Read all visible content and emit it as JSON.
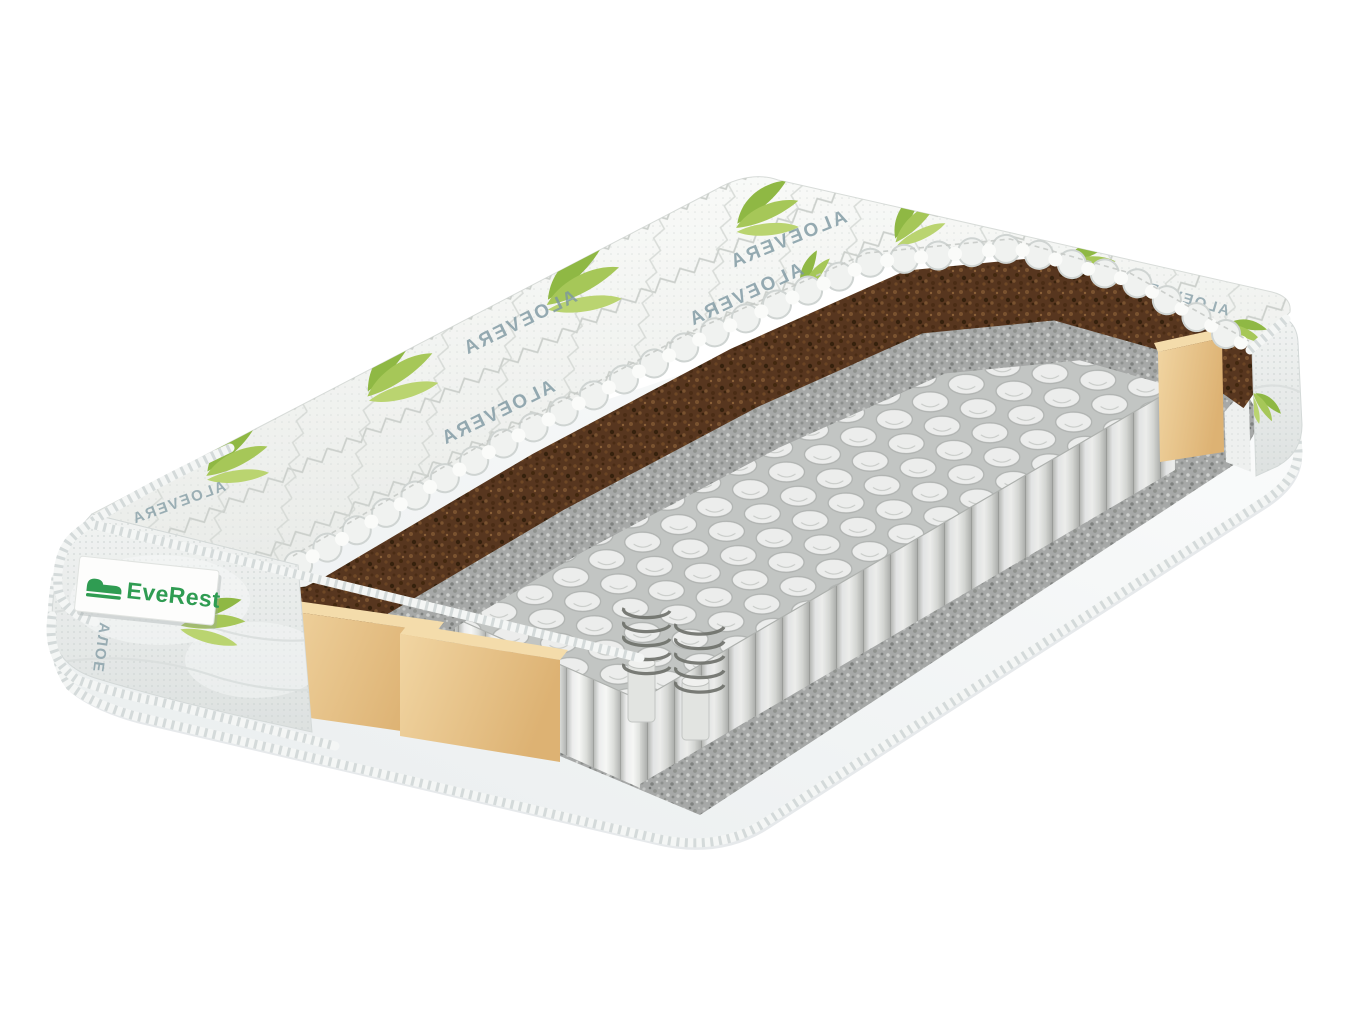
{
  "product": {
    "brand": "EveRest",
    "fabric_print": "ALOEVERA",
    "fabric_print_side": "АЛОЕ"
  },
  "colors": {
    "brand_green": "#2f9c52",
    "leaf_green": "#a6c758",
    "coir_brown": "#57361f",
    "felt_gray": "#a6a8a7",
    "foam_beige": "#eac88f",
    "spring_white": "#ecedec",
    "base_white": "#f4f6f6",
    "print_gray_blue": "#7c96a0",
    "background": "#ffffff"
  }
}
